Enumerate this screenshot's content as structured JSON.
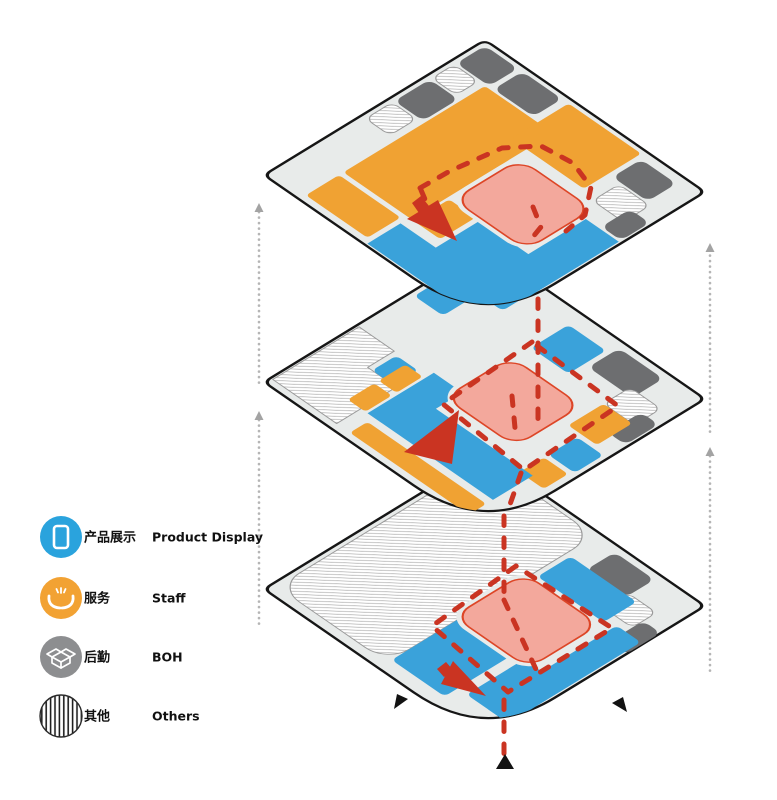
{
  "colors": {
    "blue": "#3aa2da",
    "orange": "#f0a233",
    "gray": "#6d6e70",
    "plate": "#e8ebea",
    "outline": "#161616",
    "pink": "#f3a89c",
    "pink_stroke": "#dd4627",
    "route": "#ca3422",
    "riser": "#b5b5b5",
    "riser_arrow": "#a3a3a3",
    "black": "#121212",
    "hatch_line": "#a8a8a8",
    "hatch_stroke": "#9a9a9a",
    "white": "#ffffff"
  },
  "legend": {
    "rows_y": [
      537,
      598,
      657,
      716
    ],
    "items": [
      {
        "id": "product-display",
        "zh": "产品展示",
        "en": "Product Display",
        "icon": "tablet-icon",
        "color": "#2aa3dd"
      },
      {
        "id": "staff",
        "zh": "服务",
        "en": "Staff",
        "icon": "service-hands-icon",
        "color": "#f2a233"
      },
      {
        "id": "boh",
        "zh": "后勤",
        "en": "BOH",
        "icon": "open-box-icon",
        "color": "#8d8e90"
      },
      {
        "id": "others",
        "zh": "其他",
        "en": "Others",
        "icon": "stripes-icon",
        "color": "#ffffff"
      }
    ]
  },
  "plate_path": "M 3 0 L 97 0 Q 100 0 100 3 L 100 68 Q 100 100 68 100 L 3 100 Q 0 100 0 97 L 0 3 Q 0 0 3 0 Z",
  "floors": [
    {
      "id": "level-1",
      "cy": 454,
      "zones": [
        {
          "kind": "hatch",
          "rect": [
            2,
            2,
            50,
            94
          ],
          "r": 10
        },
        {
          "kind": "gray",
          "rect": [
            62,
            3,
            18,
            13
          ],
          "r": 3
        },
        {
          "kind": "hatch",
          "rect": [
            79,
            14,
            13,
            11
          ],
          "r": 3
        },
        {
          "kind": "gray",
          "rect": [
            92,
            20,
            8,
            16
          ],
          "r": 3
        },
        {
          "kind": "blue",
          "rect": [
            54,
            15,
            30,
            15
          ],
          "r": 2
        },
        {
          "kind": "blue",
          "rect": [
            88,
            28,
            11,
            60
          ],
          "r": 2
        },
        {
          "kind": "blue",
          "rect": [
            52,
            58,
            24,
            36
          ],
          "r": 2
        },
        {
          "kind": "blue",
          "rect": [
            80,
            62,
            18,
            26
          ],
          "r": 2
        },
        {
          "kind": "pinkgap",
          "rect": [
            48,
            30,
            38,
            36
          ],
          "r": 9
        },
        {
          "kind": "pink",
          "rect": [
            50,
            32,
            34,
            32
          ],
          "r": 7
        }
      ],
      "dashes": [
        {
          "d": "M 516 566 L 432 626 L 508 692 L 612 628 Z"
        },
        {
          "d": "M 504 600 L 540 678"
        },
        {
          "d": "M 504 700 L 504 757"
        }
      ],
      "red_arrows": [
        [
          [
            437,
            669
          ],
          [
            446,
            662
          ],
          [
            453,
            670
          ],
          [
            444,
            677
          ]
        ],
        [
          [
            441,
            684
          ],
          [
            453,
            661
          ],
          [
            486,
            696
          ]
        ]
      ],
      "black_marks": [
        [
          [
            496,
            769
          ],
          [
            505,
            754
          ],
          [
            514,
            769
          ]
        ],
        [
          [
            394,
            709
          ],
          [
            408,
            699
          ],
          [
            397,
            694
          ]
        ],
        [
          [
            627,
            712
          ],
          [
            612,
            703
          ],
          [
            623,
            697
          ]
        ]
      ]
    },
    {
      "id": "level-2",
      "cy": 247,
      "zones": [
        {
          "kind": "hatchpath",
          "path": "M 1 58 L 17 58 L 17 70 L 30 70 L 30 97 L 1 97 Z"
        },
        {
          "kind": "blue",
          "rect": [
            2,
            2,
            24,
            16
          ],
          "r": 2
        },
        {
          "kind": "blue",
          "rect": [
            2,
            19,
            13,
            15
          ],
          "r": 2
        },
        {
          "kind": "blue",
          "rect": [
            19,
            59,
            10,
            11
          ],
          "r": 2
        },
        {
          "kind": "blue",
          "rect": [
            45,
            7,
            17,
            17
          ],
          "r": 2
        },
        {
          "kind": "gray",
          "rect": [
            64,
            3,
            20,
            14
          ],
          "r": 3
        },
        {
          "kind": "hatch",
          "rect": [
            80,
            14,
            14,
            12
          ],
          "r": 3
        },
        {
          "kind": "gray",
          "rect": [
            91,
            20,
            8,
            15
          ],
          "r": 3
        },
        {
          "kind": "orange",
          "rect": [
            24,
            60,
            8,
            12
          ],
          "r": 1.5
        },
        {
          "kind": "orange",
          "rect": [
            24,
            74,
            8,
            12
          ],
          "r": 1.5
        },
        {
          "kind": "orange",
          "rect": [
            36,
            89,
            54,
            8
          ],
          "r": 1.5
        },
        {
          "kind": "orange",
          "rect": [
            80,
            26,
            13,
            16
          ],
          "r": 1.5
        },
        {
          "kind": "blue",
          "rect": [
            86,
            44,
            12,
            13
          ],
          "r": 2
        },
        {
          "kind": "orange",
          "rect": [
            86,
            59,
            11,
            11
          ],
          "r": 1.5
        },
        {
          "kind": "bluepath",
          "path": "M 33 56 L 46 56 L 46 68 L 90 68 L 90 86 L 33 86 Z"
        },
        {
          "kind": "pinkgap",
          "rect": [
            42,
            30,
            36,
            34
          ],
          "r": 9
        },
        {
          "kind": "pink",
          "rect": [
            44,
            32,
            32,
            30
          ],
          "r": 7
        }
      ],
      "dashes": [
        {
          "d": "M 532 342 L 443 404 L 524 470 L 618 406 Z"
        },
        {
          "d": "M 512 396 L 515 428"
        },
        {
          "d": "M 521 473 L 507 513"
        },
        {
          "d": "M 504 516 L 504 598"
        }
      ],
      "red_arrows": [
        [
          [
            404,
            452
          ],
          [
            459,
            410
          ],
          [
            452,
            464
          ]
        ]
      ],
      "black_marks": []
    },
    {
      "id": "level-3",
      "cy": 40,
      "zones": [
        {
          "kind": "gray",
          "rect": [
            2,
            2,
            15,
            13
          ],
          "r": 3
        },
        {
          "kind": "gray",
          "rect": [
            19,
            2,
            18,
            13
          ],
          "r": 3
        },
        {
          "kind": "hatch",
          "rect": [
            2,
            16,
            11,
            10
          ],
          "r": 3
        },
        {
          "kind": "gray",
          "rect": [
            2,
            27,
            13,
            16
          ],
          "r": 3
        },
        {
          "kind": "hatch",
          "rect": [
            2,
            44,
            11,
            12
          ],
          "r": 3
        },
        {
          "kind": "orange",
          "rect": [
            16,
            16,
            31,
            64
          ],
          "r": 1.5
        },
        {
          "kind": "orange",
          "rect": [
            16,
            82,
            28,
            15
          ],
          "r": 1.5
        },
        {
          "kind": "orange",
          "rect": [
            40,
            2,
            33,
            26
          ],
          "r": 1.5
        },
        {
          "kind": "orange",
          "rect": [
            48,
            64,
            12,
            16
          ],
          "r": 1.5
        },
        {
          "kind": "gray",
          "rect": [
            75,
            4,
            16,
            13
          ],
          "r": 3
        },
        {
          "kind": "hatch",
          "rect": [
            79,
            18,
            14,
            12
          ],
          "r": 3
        },
        {
          "kind": "gray",
          "rect": [
            90,
            24,
            9,
            13
          ],
          "r": 3
        },
        {
          "kind": "bluepath",
          "path": "M 84 38 L 99 38 L 99 99 L 46 99 L 46 84 L 62 84 L 62 64 L 84 64 Z"
        },
        {
          "kind": "pinkgap",
          "rect": [
            47,
            31,
            37,
            34
          ],
          "r": 9
        },
        {
          "kind": "pink",
          "rect": [
            49,
            33,
            33,
            30
          ],
          "r": 7
        }
      ],
      "dashes": [
        {
          "d": "M 420 188 L 450 171 L 502 148 L 541 146 L 573 163 L 591 187 L 585 215 L 566 231"
        },
        {
          "d": "M 421 190 L 427 204"
        },
        {
          "d": "M 533 207 L 541 227 L 528 243"
        },
        {
          "d": "M 538 299 L 538 429"
        }
      ],
      "red_arrows": [
        [
          [
            412,
            203
          ],
          [
            421,
            196
          ],
          [
            429,
            206
          ],
          [
            419,
            213
          ]
        ],
        [
          [
            407,
            219
          ],
          [
            438,
            200
          ],
          [
            457,
            241
          ]
        ]
      ],
      "black_marks": []
    }
  ],
  "risers": [
    {
      "id": "riser-left",
      "x": 259,
      "segments": [
        [
          212,
          386
        ],
        [
          420,
          626
        ]
      ],
      "arrows": [
        203,
        411
      ]
    },
    {
      "id": "riser-right",
      "x": 710,
      "segments": [
        [
          250,
          434
        ],
        [
          456,
          672
        ]
      ],
      "arrows": [
        243,
        447
      ]
    }
  ]
}
